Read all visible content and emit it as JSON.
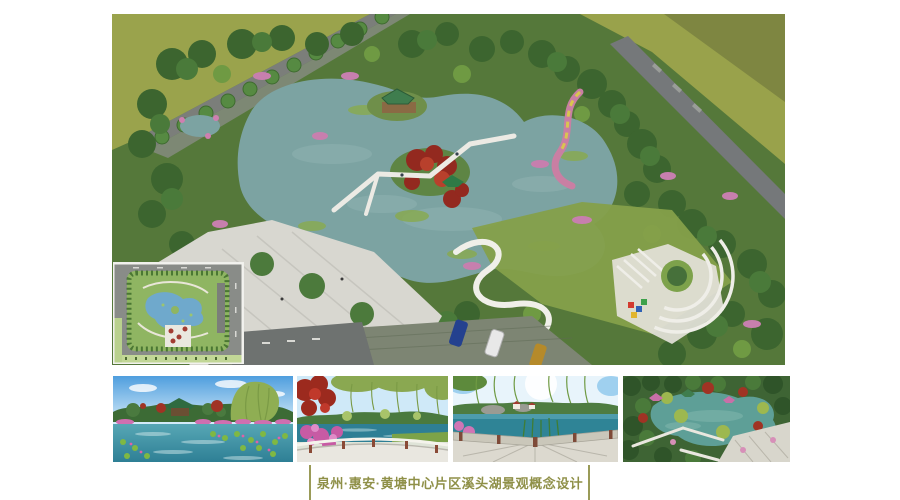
{
  "slide": {
    "title": {
      "text": "泉州·惠安·黄塘中心片区溪头湖景观概念设计",
      "color": "#8f9048"
    }
  },
  "gallery": {
    "main_render": "aerial-perspective-render-of-xitou-lake-park",
    "inset": "master-plan-top-view-inset",
    "thumbnails": [
      "lake-lotus-and-pavilion-view",
      "bridge-railing-lake-view",
      "stone-terrace-corner-lake-view",
      "aerial-lake-and-pavilions-view"
    ]
  },
  "palette": {
    "accent_olive": "#8f9048",
    "divider_olive": "#9a9b58",
    "field_olive": "#99a24b",
    "park_green": "#4d7434",
    "lake_teal": "#7ca3a2",
    "plaza_gray": "#d8d7d0",
    "thumb_water_teal": "#2e7f95",
    "sky_blue": "#4f9ede"
  }
}
